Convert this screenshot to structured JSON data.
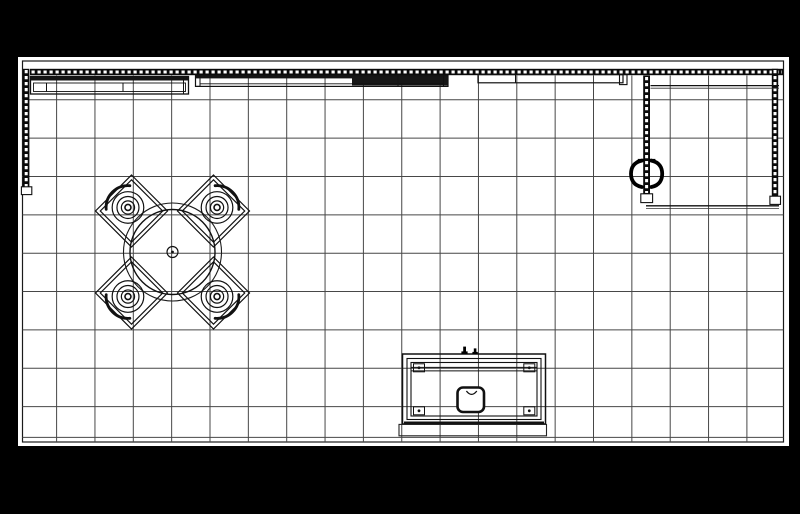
{
  "meta": {
    "kind": "cad-floor-plan",
    "description": "Top-down booth floor plan with grid, truss walls, round table with four chairs, reception counter and storage closet"
  },
  "canvas": {
    "w": 800,
    "h": 514,
    "bg": "#000000"
  },
  "paper": {
    "x": 18,
    "y": 57,
    "w": 771,
    "h": 389,
    "fill": "#ffffff"
  },
  "border": {
    "x": 22.5,
    "y": 61,
    "w": 761,
    "h": 381,
    "stroke": "#1a1a1a",
    "sw": 1.2
  },
  "colors": {
    "ink": "#111111",
    "grid": "#474747",
    "truss": "#0a0a0a",
    "dash": "#ffffff"
  },
  "grid": {
    "sw": 1,
    "x_start": 56.6,
    "x_step": 38.35,
    "x_count": 19,
    "y_top": 75.5,
    "y_bottom": 442,
    "y_start": 99.8,
    "y_step": 38.35,
    "y_count": 9,
    "x_left": 22.5,
    "x_right": 783.5,
    "extra_h": [
      437.4
    ]
  },
  "trusses": [
    {
      "n": "back-wall-truss",
      "rect": [
        30,
        68.8,
        753,
        6.4
      ],
      "line": [
        31.5,
        72,
        782,
        72
      ]
    },
    {
      "n": "left-wall-truss",
      "rect": [
        23,
        68.8,
        6.4,
        119.5
      ],
      "line": [
        26.2,
        70,
        26.2,
        187
      ]
    },
    {
      "n": "right-wall-truss",
      "rect": [
        771.8,
        68.8,
        6.4,
        128
      ],
      "line": [
        775,
        70,
        775,
        195.5
      ]
    },
    {
      "n": "closet-wall-truss",
      "rect": [
        643.2,
        75.5,
        6.8,
        119
      ],
      "line": [
        646.6,
        77,
        646.6,
        193
      ]
    }
  ],
  "truss_dash": {
    "sw": 3,
    "da": "3.2 2.8"
  },
  "layers": [
    {
      "name": "truss-feet",
      "prims": [
        {
          "t": "r",
          "n": "left-truss-foot",
          "x": 21.4,
          "y": 186.8,
          "w": 10.4,
          "h": 7.8,
          "f": "#ffffff",
          "s": "#111111",
          "sw": 1.1
        },
        {
          "t": "r",
          "n": "right-truss-foot",
          "x": 769.9,
          "y": 196.2,
          "w": 10.6,
          "h": 8.2,
          "f": "#ffffff",
          "s": "#111111",
          "sw": 1.1
        },
        {
          "t": "r",
          "n": "closet-truss-foot",
          "x": 640.8,
          "y": 193.8,
          "w": 11.8,
          "h": 8.8,
          "f": "#ffffff",
          "s": "#111111",
          "sw": 1.1
        }
      ]
    },
    {
      "name": "wall-header-panels",
      "prims": [
        {
          "t": "r",
          "n": "header-panel-a",
          "x": 30.5,
          "y": 76.5,
          "w": 158,
          "h": 17.5,
          "s": "#111111",
          "sw": 1.3
        },
        {
          "t": "r",
          "n": "header-panel-a-top",
          "x": 30.5,
          "y": 76.5,
          "w": 158,
          "h": 4,
          "f": "#141414"
        },
        {
          "t": "r",
          "n": "header-panel-a-inner",
          "x": 33.5,
          "y": 83,
          "w": 152,
          "h": 8.5,
          "s": "#111111",
          "sw": 0.9
        },
        {
          "t": "l",
          "n": "header-panel-a-divider",
          "x1": 46.5,
          "y1": 83,
          "x2": 46.5,
          "y2": 91.5,
          "s": "#111111",
          "sw": 1
        },
        {
          "t": "l",
          "n": "header-panel-a-divider",
          "x1": 123,
          "y1": 83,
          "x2": 123,
          "y2": 91.5,
          "s": "#111111",
          "sw": 1
        },
        {
          "t": "l",
          "n": "header-panel-a-endcap",
          "x1": 183.5,
          "y1": 77.5,
          "x2": 183.5,
          "y2": 93.5,
          "s": "#111111",
          "sw": 1
        },
        {
          "t": "r",
          "n": "header-panel-b",
          "x": 195.5,
          "y": 75.2,
          "w": 252.5,
          "h": 11.2,
          "s": "#111111",
          "sw": 1.2
        },
        {
          "t": "r",
          "n": "header-panel-b-top",
          "x": 195.5,
          "y": 75.2,
          "w": 252.5,
          "h": 3.2,
          "f": "#141414"
        },
        {
          "t": "r",
          "n": "header-panel-b-dark",
          "x": 352,
          "y": 76.5,
          "w": 96,
          "h": 9,
          "f": "#161616"
        },
        {
          "t": "l",
          "n": "header-panel-b-shelf",
          "x1": 200,
          "y1": 83.8,
          "x2": 443,
          "y2": 83.8,
          "s": "#111111",
          "sw": 0.9
        },
        {
          "t": "l",
          "n": "header-panel-b-divider",
          "x1": 398,
          "y1": 75.2,
          "x2": 398,
          "y2": 86.4,
          "s": "#111111",
          "sw": 1
        },
        {
          "t": "r",
          "n": "header-panel-b-endcap",
          "x": 195.5,
          "y": 75.2,
          "w": 4.5,
          "h": 11.2,
          "s": "#111111",
          "sw": 1
        },
        {
          "t": "r",
          "n": "header-panel-b-endcap",
          "x": 443.5,
          "y": 75.2,
          "w": 4.5,
          "h": 11.2,
          "s": "#111111",
          "sw": 1
        },
        {
          "t": "r",
          "n": "header-panel-c",
          "x": 478,
          "y": 74.6,
          "w": 145,
          "h": 8.2,
          "s": "#111111",
          "sw": 1.2
        },
        {
          "t": "l",
          "n": "header-panel-c-divider",
          "x1": 515.5,
          "y1": 74.6,
          "x2": 515.5,
          "y2": 82.8,
          "s": "#111111",
          "sw": 1
        },
        {
          "t": "r",
          "n": "header-panel-c-endcap",
          "x": 619.5,
          "y": 74.6,
          "w": 7.5,
          "h": 10,
          "s": "#111111",
          "sw": 1.1
        }
      ]
    },
    {
      "name": "storage-closet",
      "prims": [
        {
          "t": "l",
          "n": "closet-top-wall",
          "x1": 650.5,
          "y1": 85.6,
          "x2": 779,
          "y2": 85.6,
          "s": "#111111",
          "sw": 1.2
        },
        {
          "t": "l",
          "n": "closet-top-wall",
          "x1": 650.5,
          "y1": 88.2,
          "x2": 779,
          "y2": 88.2,
          "s": "#333333",
          "sw": 0.8
        },
        {
          "t": "l",
          "n": "closet-bottom-wall",
          "x1": 646,
          "y1": 205.8,
          "x2": 779,
          "y2": 205.8,
          "s": "#111111",
          "sw": 1.4
        },
        {
          "t": "l",
          "n": "closet-bottom-wall",
          "x1": 646,
          "y1": 208.4,
          "x2": 779,
          "y2": 208.4,
          "s": "#333333",
          "sw": 0.8
        }
      ]
    },
    {
      "name": "monitor-mount",
      "prims": [
        {
          "t": "p",
          "n": "mount-left-hook",
          "d": "M641.8,160.6 C633.6,162.2 631,168 631,173.8 C631,179.6 633.6,185.4 641.8,187",
          "s": "#000000",
          "sw": 3.8,
          "cap": "round"
        },
        {
          "t": "p",
          "n": "mount-right-hook",
          "d": "M651.4,160.6 C659.6,162.2 662.2,168 662.2,173.8 C662.2,179.6 659.6,185.4 651.4,187",
          "s": "#000000",
          "sw": 3.8,
          "cap": "round"
        },
        {
          "t": "l",
          "n": "mount-top-tick",
          "x1": 637.8,
          "y1": 159.9,
          "x2": 644.2,
          "y2": 159.9,
          "s": "#000000",
          "sw": 2
        },
        {
          "t": "l",
          "n": "mount-top-tick",
          "x1": 649,
          "y1": 159.9,
          "x2": 655.4,
          "y2": 159.9,
          "s": "#000000",
          "sw": 2
        }
      ]
    },
    {
      "name": "reception-counter",
      "prims": [
        {
          "t": "r",
          "n": "counter-outer",
          "x": 402.5,
          "y": 354,
          "w": 143,
          "h": 70,
          "s": "#111111",
          "sw": 1.5
        },
        {
          "t": "r",
          "n": "counter-mid",
          "x": 407,
          "y": 358.5,
          "w": 134,
          "h": 61,
          "s": "#111111",
          "sw": 1.1
        },
        {
          "t": "r",
          "n": "counter-inner",
          "x": 411,
          "y": 362.5,
          "w": 126,
          "h": 53.5,
          "s": "#111111",
          "sw": 1.1
        },
        {
          "t": "l",
          "n": "counter-shelf-line",
          "x1": 411,
          "y1": 367.4,
          "x2": 537,
          "y2": 367.4,
          "s": "#111111",
          "sw": 1
        },
        {
          "t": "l",
          "n": "counter-shelf-line",
          "x1": 411,
          "y1": 370.9,
          "x2": 537,
          "y2": 370.9,
          "s": "#111111",
          "sw": 1
        },
        {
          "t": "l",
          "n": "counter-front-edge",
          "x1": 404,
          "y1": 422.9,
          "x2": 544,
          "y2": 422.9,
          "s": "#111111",
          "sw": 2.8
        },
        {
          "t": "r",
          "n": "counter-bracket",
          "x": 413.5,
          "y": 363.8,
          "w": 11,
          "h": 8,
          "s": "#111111",
          "sw": 1
        },
        {
          "t": "c",
          "n": "counter-bracket-dot",
          "cx": 419,
          "cy": 367.8,
          "r": 1.4,
          "f": "#111111"
        },
        {
          "t": "r",
          "n": "counter-bracket",
          "x": 523.8,
          "y": 363.8,
          "w": 11,
          "h": 8,
          "s": "#111111",
          "sw": 1
        },
        {
          "t": "c",
          "n": "counter-bracket-dot",
          "cx": 529.3,
          "cy": 367.8,
          "r": 1.4,
          "f": "#111111"
        },
        {
          "t": "r",
          "n": "counter-bracket",
          "x": 413.5,
          "y": 406.8,
          "w": 11,
          "h": 8,
          "s": "#111111",
          "sw": 1
        },
        {
          "t": "c",
          "n": "counter-bracket-dot",
          "cx": 419,
          "cy": 410.8,
          "r": 1.4,
          "f": "#111111"
        },
        {
          "t": "r",
          "n": "counter-bracket",
          "x": 523.8,
          "y": 406.8,
          "w": 11,
          "h": 8,
          "s": "#111111",
          "sw": 1
        },
        {
          "t": "c",
          "n": "counter-bracket-dot",
          "cx": 529.3,
          "cy": 410.8,
          "r": 1.4,
          "f": "#111111"
        },
        {
          "t": "r",
          "n": "counter-sink",
          "x": 457.5,
          "y": 387.5,
          "w": 26.5,
          "h": 24.5,
          "rx": 5.5,
          "f": "#ffffff",
          "s": "#111111",
          "sw": 2.6
        },
        {
          "t": "p",
          "n": "counter-sink-cup",
          "d": "M466.4,391 q5.2,6.8 10.4,0",
          "s": "#111111",
          "sw": 1.3
        },
        {
          "t": "r",
          "n": "counter-clip",
          "x": 463.2,
          "y": 346.6,
          "w": 2.8,
          "h": 6.2,
          "f": "#000000"
        },
        {
          "t": "r",
          "n": "counter-clip",
          "x": 461.4,
          "y": 351.4,
          "w": 6.2,
          "h": 2.4,
          "f": "#000000"
        },
        {
          "t": "r",
          "n": "counter-clip",
          "x": 473.8,
          "y": 348.4,
          "w": 2.6,
          "h": 4.8,
          "f": "#000000"
        },
        {
          "t": "r",
          "n": "counter-clip",
          "x": 472.4,
          "y": 351.9,
          "w": 5.4,
          "h": 2.2,
          "f": "#000000"
        },
        {
          "t": "r",
          "n": "counter-platform",
          "x": 399,
          "y": 424.4,
          "w": 147.5,
          "h": 11.4,
          "s": "#222222",
          "sw": 1.1
        }
      ]
    },
    {
      "name": "round-table",
      "prims": [
        {
          "t": "c",
          "n": "table-clearance-circle",
          "cx": 172.5,
          "cy": 252,
          "r": 49,
          "s": "#1a1a1a",
          "sw": 1.1
        },
        {
          "t": "c",
          "n": "table-top-circle",
          "cx": 172.5,
          "cy": 252,
          "r": 42.5,
          "s": "#111111",
          "sw": 1.4
        },
        {
          "t": "c",
          "n": "table-base-circle",
          "cx": 172.5,
          "cy": 252,
          "r": 5.5,
          "s": "#111111",
          "sw": 1.2
        },
        {
          "t": "c",
          "n": "table-center-dot",
          "cx": 172.5,
          "cy": 252,
          "r": 1.4,
          "f": "#111111"
        }
      ]
    }
  ],
  "chairs": {
    "centers": [
      [
        131.5,
        211
      ],
      [
        213.5,
        211
      ],
      [
        131.5,
        293
      ],
      [
        213.5,
        293
      ]
    ],
    "dirs": [
      [
        -1,
        -1
      ],
      [
        1,
        -1
      ],
      [
        -1,
        1
      ],
      [
        1,
        1
      ]
    ],
    "half_diag": 36,
    "inner_half": 31.2,
    "seat_radii": [
      15.8,
      11,
      6.6
    ],
    "hub_r": 3,
    "seat_offset": 5,
    "back_r": 21.8,
    "back_sw": 2.8,
    "back_span": 100,
    "stroke": "#111111",
    "sw": 1.2
  }
}
